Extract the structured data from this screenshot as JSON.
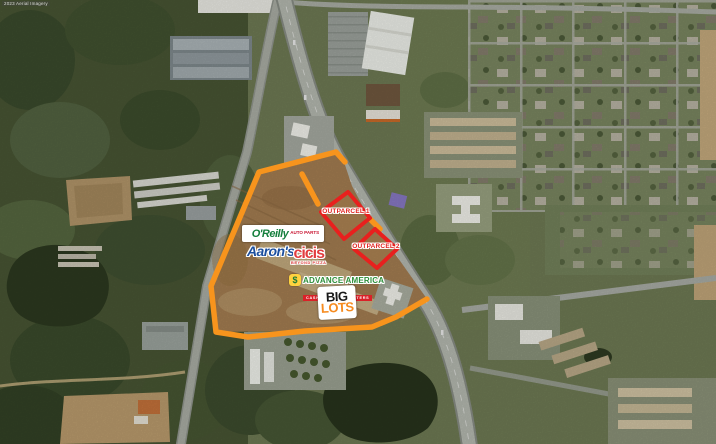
{
  "attribution": "2023 Aerial Imagery",
  "overlay": {
    "outline_color": "#F7941D",
    "outparcel_color": "#E8201E",
    "outparcel_1_label": "OUTPARCEL 1",
    "outparcel_2_label": "OUTPARCEL 2"
  },
  "tenants": {
    "oreilly_name": "O'Reilly",
    "oreilly_sub": "AUTO PARTS",
    "aarons_name": "Aaron's",
    "cicis_name": "cicis",
    "cicis_sub": "BEYOND PIZZA",
    "advance_icon": "$",
    "advance_name": "ADVANCE AMERICA",
    "advance_sub": "CASH ADVANCE CENTERS",
    "biglots_line1": "BIG",
    "biglots_line2": "LOTS"
  }
}
